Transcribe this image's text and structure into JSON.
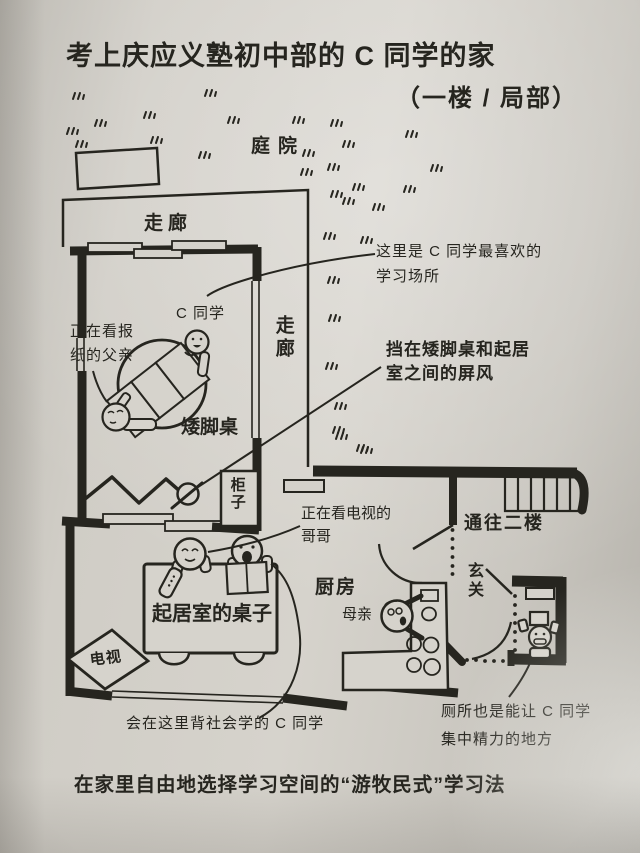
{
  "page": {
    "title": "考上庆应义塾初中部的 C 同学的家",
    "subtitle": "（一楼 / 局部）",
    "caption": "在家里自由地选择学习空间的“游牧民式”学习法"
  },
  "plan": {
    "rooms": {
      "garden": "庭院",
      "corridor_top": "走廊",
      "corridor_side": "走廊",
      "kitchen": "厨房",
      "entrance": "玄关",
      "to_second_floor": "通往二楼"
    },
    "furniture": {
      "low_table": "矮脚桌",
      "cabinet": "柜子",
      "living_table": "起居室的桌子",
      "tv": "电视"
    },
    "people": {
      "student": "C 同学",
      "mother": "母亲"
    },
    "annotations": {
      "favorite_spot": {
        "line1": "这里是 C 同学最喜欢的",
        "line2": "学习场所"
      },
      "screen": {
        "line1": "挡在矮脚桌和起居",
        "line2": "室之间的屏风"
      },
      "father": {
        "line1": "正在看报",
        "line2": "纸的父亲"
      },
      "brother": {
        "line1": "正在看电视的",
        "line2": "哥哥"
      },
      "social_studies": "会在这里背社会学的 C 同学",
      "toilet": {
        "line1": "厕所也是能让 C 同学",
        "line2": "集中精力的地方"
      }
    }
  },
  "colors": {
    "paper": "#d2cfc8",
    "ink": "#26251f"
  }
}
